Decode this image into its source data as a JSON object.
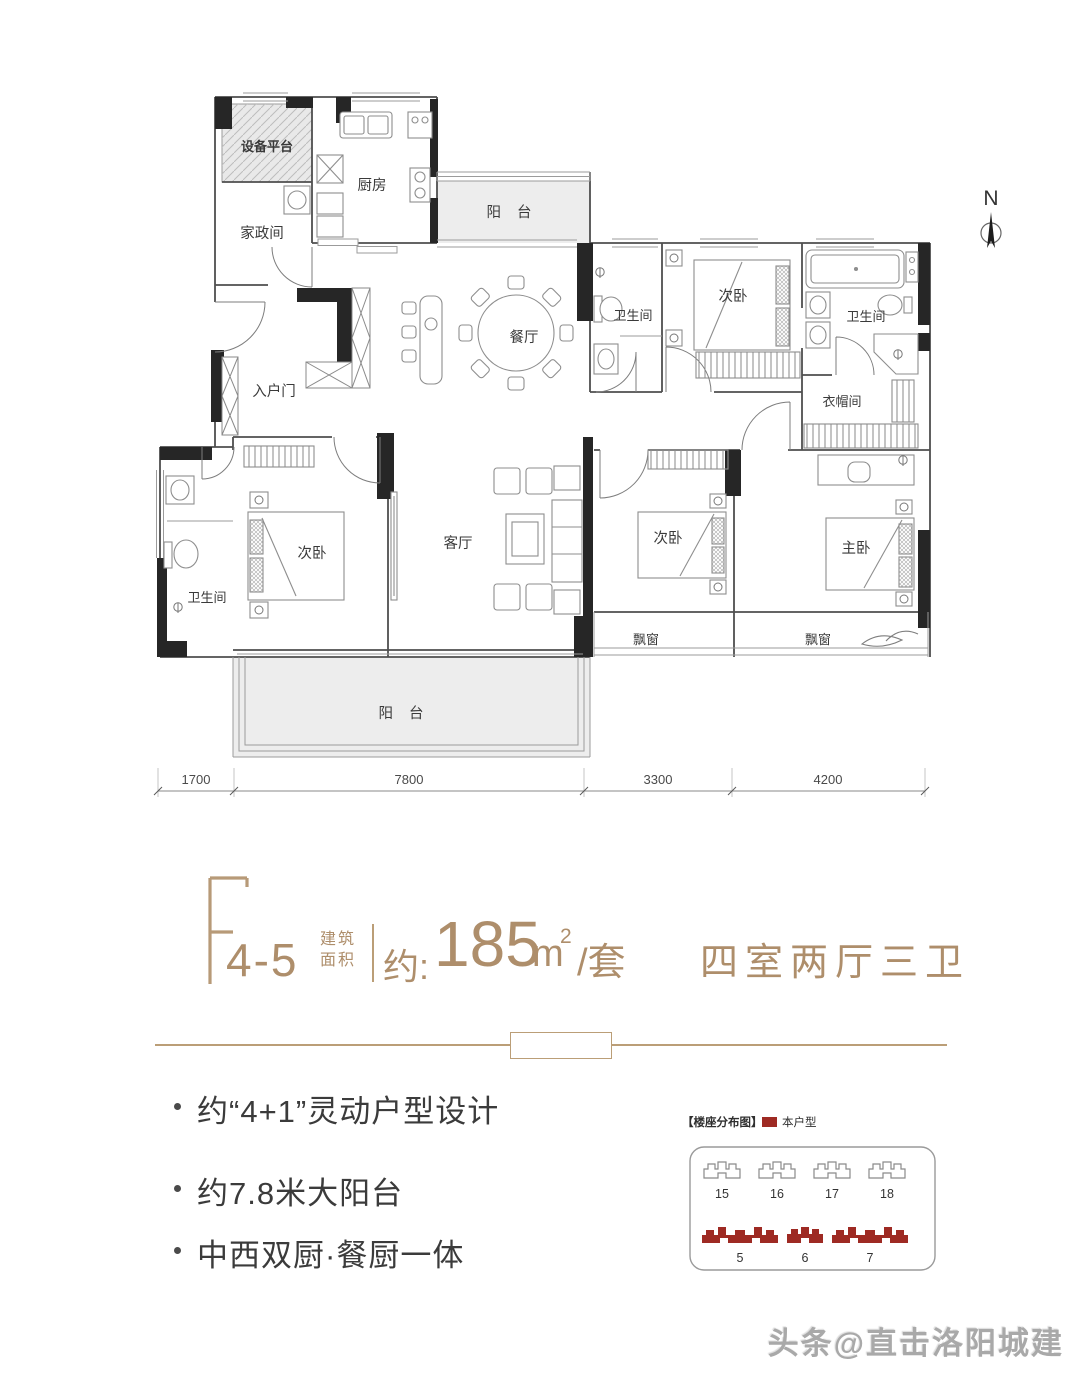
{
  "floor_plan": {
    "north_label": "N",
    "rooms": {
      "equipment_platform": "设备平台",
      "housekeeping": "家政间",
      "kitchen": "厨房",
      "balcony_top": "阳 台",
      "dining": "餐厅",
      "bath_top_middle": "卫生间",
      "bedroom_top": "次卧",
      "bath_top_right": "卫生间",
      "cloakroom": "衣帽间",
      "entry_door": "入户门",
      "bedroom_left": "次卧",
      "living_room": "客厅",
      "bedroom_middle": "次卧",
      "master_bedroom": "主卧",
      "bath_left": "卫生间",
      "bay_window_left": "飘窗",
      "bay_window_right": "飘窗",
      "balcony_bottom": "阳 台"
    },
    "dimensions": [
      "1700",
      "7800",
      "3300",
      "4200"
    ]
  },
  "title": {
    "unit_code_letter": "F",
    "unit_code_number": "4-5",
    "area_label_top": "建筑",
    "area_label_bottom": "面积",
    "area_prefix": "约:",
    "area_value": "185",
    "area_unit": "m",
    "area_unit_sup": "2",
    "area_suffix": "/套",
    "layout_summary": "四室两厅三卫"
  },
  "features": {
    "items": [
      "约“4+1”灵动户型设计",
      "约7.8米大阳台",
      "中西双厨·餐厨一体"
    ]
  },
  "distribution": {
    "title": "【楼座分布图】",
    "legend_label": "本户型",
    "top_row": [
      "15",
      "16",
      "17",
      "18"
    ],
    "bottom_row": [
      "5",
      "6",
      "7"
    ]
  },
  "watermark": "头条@直击洛阳城建",
  "colors": {
    "accent_gold": "#ae8e6b",
    "highlight_red": "#9e2a23"
  }
}
